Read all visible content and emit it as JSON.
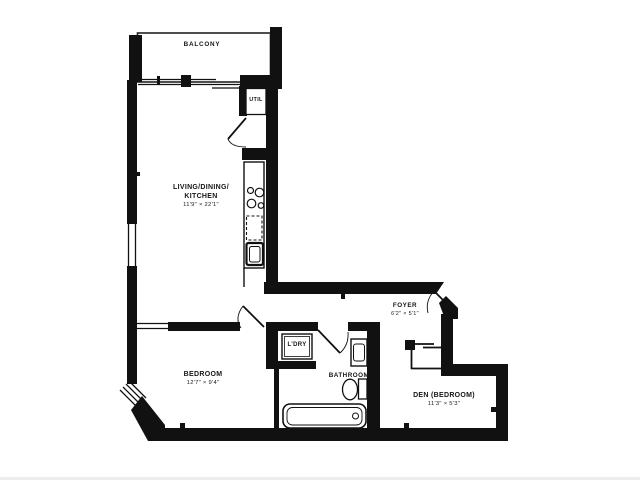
{
  "plan": {
    "colors": {
      "wall": "#111111",
      "text": "#161616"
    },
    "rooms": {
      "balcony": {
        "label": "BALCONY"
      },
      "util": {
        "label": "UTIL"
      },
      "living": {
        "line1": "LIVING/DINING/",
        "line2": "KITCHEN",
        "dims": "11'9\" × 22'1\""
      },
      "foyer": {
        "label": "FOYER",
        "dims": "6'2\" × 5'1\""
      },
      "laundry": {
        "label": "L'DRY"
      },
      "bedroom": {
        "label": "BEDROOM",
        "dims": "12'7\" × 9'4\""
      },
      "bathroom": {
        "label": "BATHROOM"
      },
      "den": {
        "label": "DEN (BEDROOM)",
        "dims": "11'3\" × 5'3\""
      }
    }
  }
}
